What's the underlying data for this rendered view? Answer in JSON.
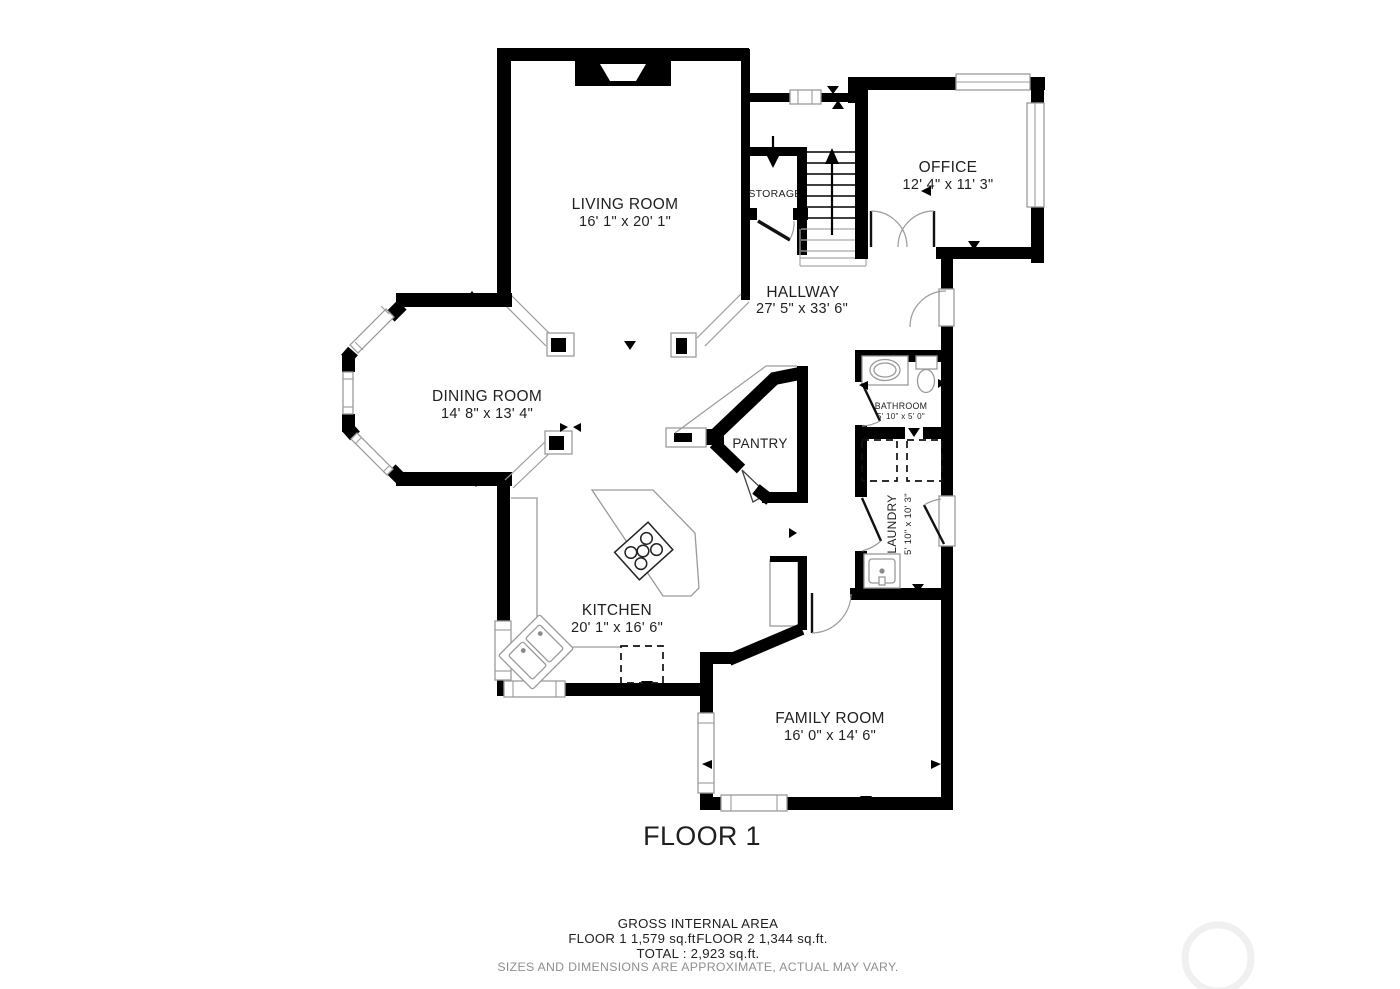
{
  "palette": {
    "wall": "#000000",
    "thin_line": "#9b9b9b",
    "text": "#1f1f1f",
    "muted_text": "#8f8f8f",
    "watermark": "#f0f0f0",
    "background": "#ffffff"
  },
  "title": "FLOOR 1",
  "rooms": {
    "living": {
      "name": "LIVING ROOM",
      "dims": "16' 1\" x 20' 1\""
    },
    "office": {
      "name": "OFFICE",
      "dims": "12' 4\" x 11' 3\""
    },
    "hallway": {
      "name": "HALLWAY",
      "dims": "27' 5\" x 33' 6\""
    },
    "storage": {
      "name": "STORAGE"
    },
    "dining": {
      "name": "DINING ROOM",
      "dims": "14' 8\" x 13' 4\""
    },
    "bathroom": {
      "name": "BATHROOM",
      "dims": "5' 10\" x 5' 0\""
    },
    "laundry": {
      "name": "LAUNDRY",
      "dims": "5' 10\" x 10' 3\""
    },
    "pantry": {
      "name": "PANTRY"
    },
    "kitchen": {
      "name": "KITCHEN",
      "dims": "20' 1\" x 16' 6\""
    },
    "family": {
      "name": "FAMILY ROOM",
      "dims": "16' 0\" x 14' 6\""
    }
  },
  "footer": {
    "heading": "GROSS INTERNAL AREA",
    "floor1_area": "FLOOR 1 1,579 sq.ft.",
    "floor2_area": "FLOOR 2 1,344 sq.ft.",
    "total": "TOTAL :  2,923 sq.ft.",
    "disclaimer": "SIZES AND DIMENSIONS ARE APPROXIMATE, ACTUAL MAY VARY."
  }
}
